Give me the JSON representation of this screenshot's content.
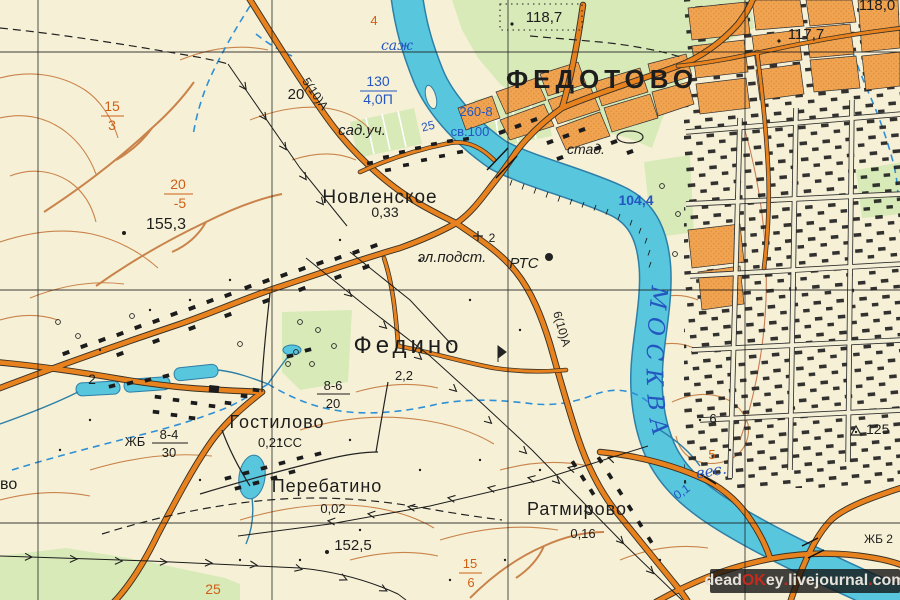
{
  "map": {
    "settlements": {
      "fedotovo": "ФЕДОТОВО",
      "novlenskoe": "Новленское",
      "fedino": "Федино",
      "gostilovo": "Гостилово",
      "perebatino": "Перебатино",
      "ratmirovo": "Ратмирово",
      "edge_cut_name": "во"
    },
    "populations": {
      "novlenskoe": "0,33",
      "fedino": "2,2",
      "gostilovo": "0,21СС",
      "perebatino": "0,02",
      "ratmirovo": "0,16"
    },
    "elevations": {
      "e1187": "118,7",
      "e1177": "117,7",
      "e1180": "118,0",
      "e1553": "155,3",
      "e1525": "152,5",
      "e125": "125",
      "n6": "6",
      "n20": "20",
      "n2_pole": "2",
      "km2": "2"
    },
    "hydro": {
      "river_name": "МОСКВА",
      "ves": "вес.",
      "sazh": "саж",
      "width_num": "130",
      "width_den": "4,0П",
      "bridge_dims": "260-8",
      "bridge_cap": "св.100",
      "bridge_25": "25",
      "water_level": "104,4",
      "depth_01": "0,1",
      "zhb2": "ЖБ 2"
    },
    "roads": {
      "grade_a": "5(10)А",
      "grade_b": "6(10)А"
    },
    "objects": {
      "el_podst": "эл.подст.",
      "rts": "РТС",
      "stadium": "стад.",
      "sad_uch": "сад.уч.",
      "zhb": "ЖБ",
      "f84_num": "8-4",
      "f84_den": "30",
      "f86_num": "8-6",
      "f86_den": "20"
    },
    "orange_marks": {
      "f153_num": "15",
      "f153_den": "3",
      "f205_num": "20",
      "f205_den": "-5",
      "f156_num": "15",
      "f156_den": "6",
      "n25": "25",
      "n4": "4",
      "n5": "5"
    },
    "colors": {
      "background": "#f6f1d6",
      "green": "#d8eab8",
      "water": "#58c6dc",
      "water_edge": "#2d7fa8",
      "road_orange": "#e8821e",
      "block_orange": "#f0a452",
      "contour": "#c9834b",
      "blue_label": "#2356c0",
      "orange_label": "#cf5f16",
      "watermark_red": "#c9281d"
    }
  },
  "watermark": {
    "parts": [
      {
        "t": "dead"
      },
      {
        "t": "OK"
      },
      {
        "t": "ey"
      },
      {
        "t": "."
      },
      {
        "t": "livejournal"
      },
      {
        "t": "."
      },
      {
        "t": "com"
      }
    ]
  }
}
